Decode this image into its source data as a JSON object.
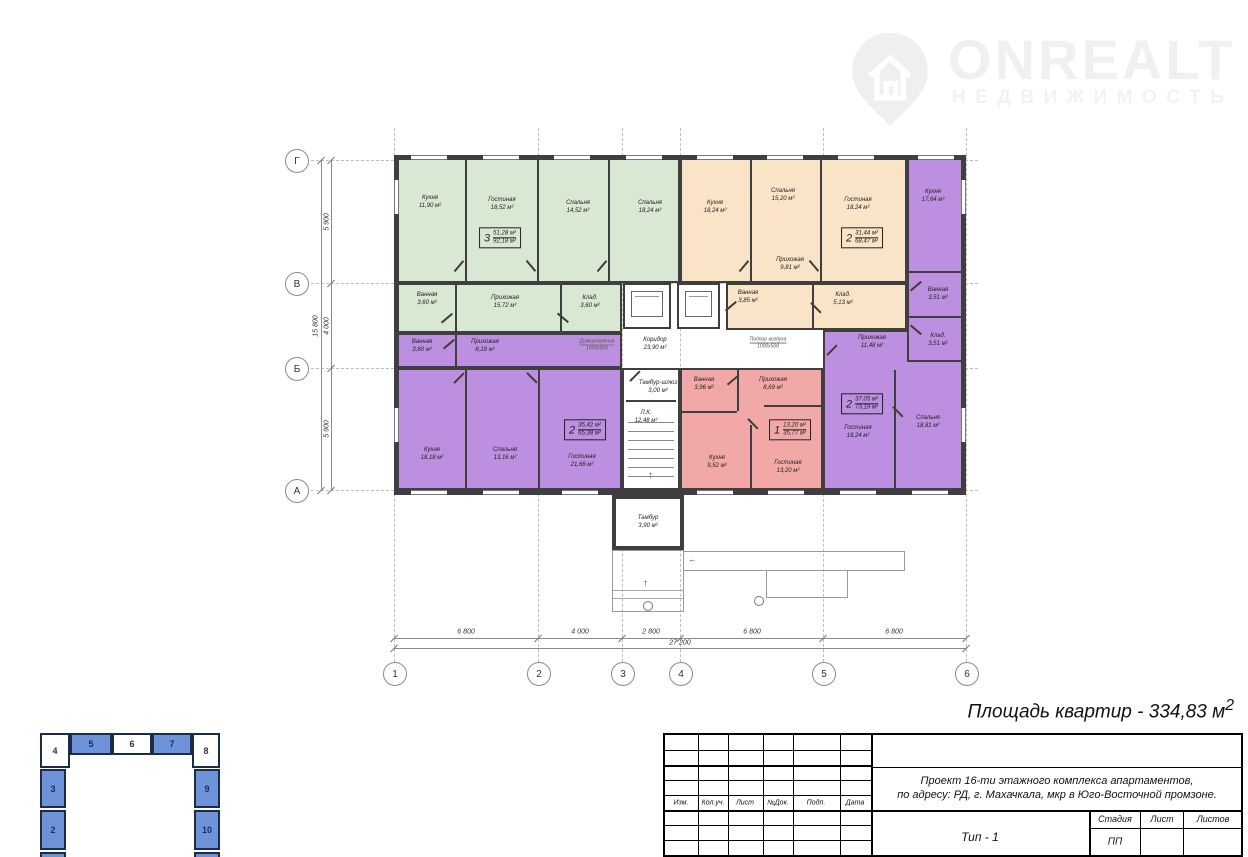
{
  "logo": {
    "brand": "ONREALT",
    "subtitle": "НЕДВИЖИМОСТЬ"
  },
  "summary": {
    "text": "Площадь квартир - 334,83 м",
    "sup": "2"
  },
  "plan_colors": {
    "wall": "#3f3f3f"
  },
  "grid": {
    "cols": [
      "1",
      "2",
      "3",
      "4",
      "5",
      "6"
    ],
    "rows": [
      "Г",
      "В",
      "Б",
      "А"
    ],
    "dims_bottom": [
      "6 800",
      "4 000",
      "2 800",
      "6 800",
      "6 800"
    ],
    "total_bottom": "27 200",
    "dims_left": [
      "5 900",
      "4 000",
      "5 900"
    ],
    "total_left": "15 800"
  },
  "annotations": {
    "smoke": "Дымоудаление",
    "smoke_size": "1000х500",
    "air": "Подпор воздуха",
    "air_size": "1000х500"
  },
  "icons": {
    "arrow_up": "↑",
    "arrow_left": "←"
  },
  "apartments": [
    {
      "name": "3-комнатная",
      "color": "#d9e8d3",
      "badge": {
        "rooms": "3",
        "living": "51,28 м²",
        "total": "92,18 м²"
      },
      "rooms": [
        {
          "name": "Кухня",
          "area": "11,90 м²"
        },
        {
          "name": "Гостиная",
          "area": "18,52 м²"
        },
        {
          "name": "Спальня",
          "area": "14,52 м²"
        },
        {
          "name": "Спальня",
          "area": "18,24 м²"
        },
        {
          "name": "Ванная",
          "area": "3,60 м²"
        },
        {
          "name": "Прихожая",
          "area": "15,72 м²"
        },
        {
          "name": "Клад.",
          "area": "3,60 м²"
        }
      ]
    },
    {
      "name": "2-комнатная",
      "color": "#f9e4c8",
      "badge": {
        "rooms": "2",
        "living": "31,44 м²",
        "total": "68,47 м²"
      },
      "rooms": [
        {
          "name": "Кухня",
          "area": "18,24 м²"
        },
        {
          "name": "Спальня",
          "area": "15,20 м²"
        },
        {
          "name": "Гостиная",
          "area": "18,24 м²"
        },
        {
          "name": "Прихожая",
          "area": "9,81 м²"
        },
        {
          "name": "Ванная",
          "area": "3,85 м²"
        },
        {
          "name": "Клад.",
          "area": "5,13 м²"
        }
      ]
    },
    {
      "name": "2-комнатная",
      "color": "#bd8fe0",
      "badge": {
        "rooms": "2",
        "living": "37,05 м²",
        "total": "73,19 м²"
      },
      "rooms": [
        {
          "name": "Кухня",
          "area": "17,64 м²"
        },
        {
          "name": "Ванная",
          "area": "3,51 м²"
        },
        {
          "name": "Прихожая",
          "area": "11,48 м²"
        },
        {
          "name": "Клад.",
          "area": "3,51 м²"
        },
        {
          "name": "Гостиная",
          "area": "18,24 м²"
        },
        {
          "name": "Спальня",
          "area": "18,81 м²"
        }
      ]
    },
    {
      "name": "2-комнатная",
      "color": "#bd8fe0",
      "badge": {
        "rooms": "2",
        "living": "35,42 м²",
        "total": "65,38 м²"
      },
      "rooms": [
        {
          "name": "Ванная",
          "area": "3,60 м²"
        },
        {
          "name": "Прихожая",
          "area": "8,18 м²"
        },
        {
          "name": "Кухня",
          "area": "18,18 м²"
        },
        {
          "name": "Спальня",
          "area": "13,16 м²"
        },
        {
          "name": "Гостиная",
          "area": "21,66 м²"
        }
      ]
    },
    {
      "name": "1-комнатная",
      "color": "#f3a8a8",
      "badge": {
        "rooms": "1",
        "living": "13,20 м²",
        "total": "35,77 м²"
      },
      "rooms": [
        {
          "name": "Ванная",
          "area": "3,96 м²"
        },
        {
          "name": "Прихожая",
          "area": "8,69 м²"
        },
        {
          "name": "Кухня",
          "area": "9,52 м²"
        },
        {
          "name": "Гостиная",
          "area": "13,20 м²"
        }
      ]
    }
  ],
  "common_rooms": [
    {
      "name": "Коридор",
      "area": "23,90 м²"
    },
    {
      "name": "Тамбур-шлюз",
      "area": "3,00 м²"
    },
    {
      "name": "Л.К.",
      "area": "12,48 м²"
    },
    {
      "name": "Тамбур",
      "area": "3,90 м²"
    }
  ],
  "title_block": {
    "header_cols": [
      "Изм.",
      "Кол.уч.",
      "Лист",
      "№Док.",
      "Подп.",
      "Дата"
    ],
    "project_line1": "Проект 16-ти этажного комплекса апартаментов,",
    "project_line2": "по адресу: РД, г. Махачкала, мкр в Юго-Восточной промзоне.",
    "type_label": "Тип - 1",
    "stage_col": "Стадия",
    "sheet_col": "Лист",
    "sheets_col": "Листов",
    "stage_value": "ПП"
  },
  "key_plan": {
    "highlight_color": "#6e93d8",
    "cells": [
      {
        "label": "4"
      },
      {
        "label": "5"
      },
      {
        "label": "6"
      },
      {
        "label": "7"
      },
      {
        "label": "8"
      },
      {
        "label": "3"
      },
      {
        "label": "9"
      },
      {
        "label": "2"
      },
      {
        "label": "10"
      }
    ]
  }
}
